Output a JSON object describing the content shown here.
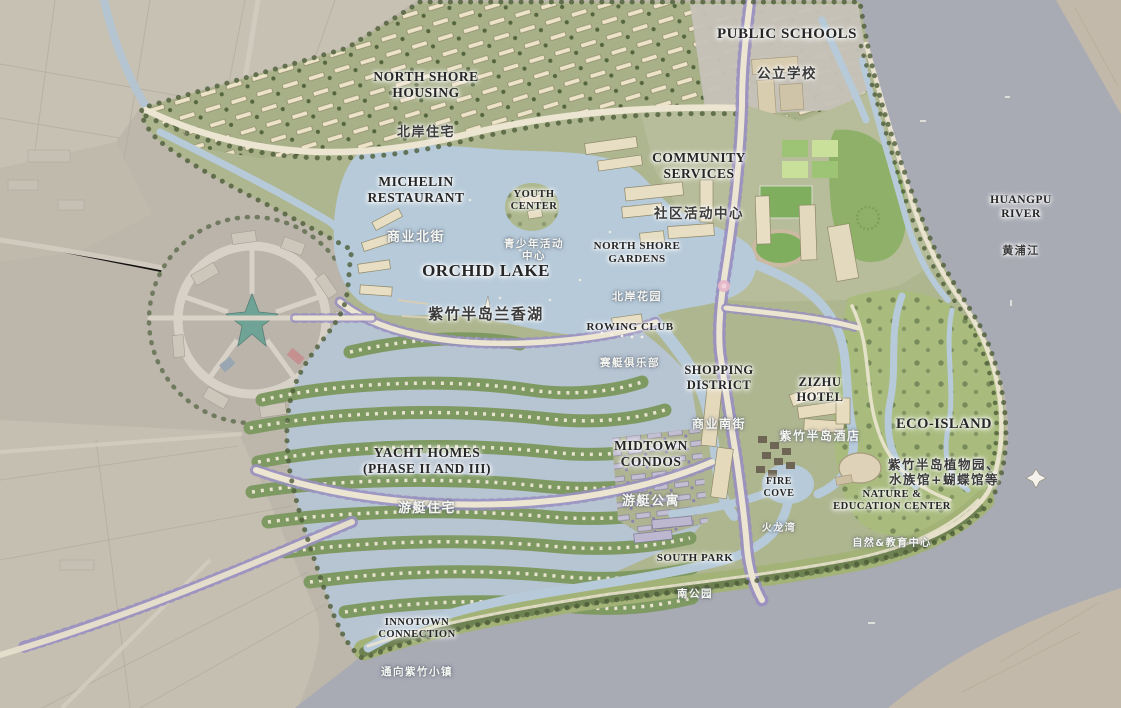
{
  "map": {
    "labels": {
      "public_schools": {
        "en": "PUBLIC SCHOOLS",
        "zh": "公立学校"
      },
      "north_shore_housing": {
        "en": "NORTH SHORE\nHOUSING",
        "zh": "北岸住宅"
      },
      "michelin_restaurant": {
        "en": "MICHELIN\nRESTAURANT",
        "zh": "商业北街"
      },
      "youth_center": {
        "en": "YOUTH\nCENTER",
        "zh": "青少年活动\n中心"
      },
      "community_services": {
        "en": "COMMUNITY\nSERVICES",
        "zh": "社区活动中心"
      },
      "huangpu_river": {
        "en": "HUANGPU RIVER",
        "zh": "黄浦江"
      },
      "north_shore_gardens": {
        "en": "NORTH SHORE\nGARDENS",
        "zh": "北岸花园"
      },
      "orchid_lake": {
        "en": "ORCHID LAKE",
        "zh": "紫竹半岛兰香湖"
      },
      "rowing_club": {
        "en": "ROWING CLUB",
        "zh": "赛艇俱乐部"
      },
      "shopping_district": {
        "en": "SHOPPING\nDISTRICT",
        "zh": "商业南街"
      },
      "zizhu_hotel": {
        "en": "ZIZHU\nHOTEL",
        "zh": "紫竹半岛酒店"
      },
      "eco_island": {
        "en": "ECO-ISLAND",
        "zh": "紫竹半岛植物园、\n水族馆+蝴蝶馆等"
      },
      "yacht_homes": {
        "en": "YACHT HOMES\n(PHASE II AND III)",
        "zh": "游艇住宅"
      },
      "midtown_condos": {
        "en": "MIDTOWN\nCONDOS",
        "zh": "游艇公寓"
      },
      "fire_cove": {
        "en": "FIRE\nCOVE",
        "zh": "火龙湾"
      },
      "nature_education": {
        "en": "NATURE &\nEDUCATION CENTER",
        "zh": "自然&教育中心"
      },
      "south_park": {
        "en": "SOUTH PARK",
        "zh": "南公园"
      },
      "innotown_connection": {
        "en": "INNOTOWN\nCONNECTION",
        "zh": "通向紫竹小镇"
      }
    },
    "colors": {
      "river": "#a8aab4",
      "lake": "#b6cad9",
      "plan_land": "#aeb690",
      "park_green": "#9fb173",
      "faded_land": "#c4beb1",
      "road": "#ece5d2",
      "boulevard_trees": "#998fc1",
      "tree_line": "#4c5c38",
      "building": "#e7decb",
      "label_dark": "#262626",
      "label_light": "#f7f7f2"
    }
  }
}
